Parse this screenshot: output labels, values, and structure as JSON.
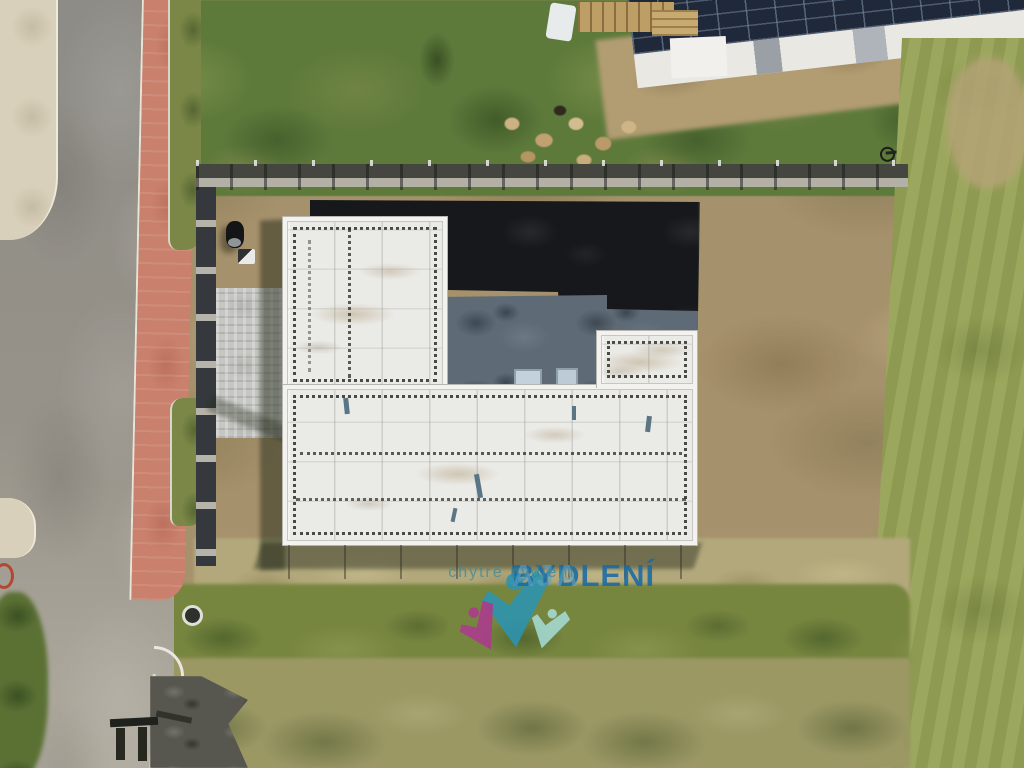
{
  "watermark": {
    "brand": "BYDLENÍ",
    "suffix": "AJA",
    "tagline": "chytré bydlení",
    "colors": {
      "figure_center": "#2b93b0",
      "figure_left": "#ab3a8e",
      "figure_right": "#a5dad4",
      "wordmark": "#1b6aa3",
      "suffix_color": "#63a0bd",
      "tagline_color": "#2f89a0"
    }
  },
  "scene_palette": {
    "asphalt_road": "#8d8c87",
    "sidewalk": "#d9d0bb",
    "red_pavers": "#c9806c",
    "grass_top": "#5e7a3b",
    "meadow_right": "#96a255",
    "bare_dirt": "#a5916b",
    "roof_membrane": "#eaeae6",
    "terrace_pavers": "#5e6b76",
    "topsoil_patch": "#17181b",
    "solar_roof": "#20293a"
  }
}
